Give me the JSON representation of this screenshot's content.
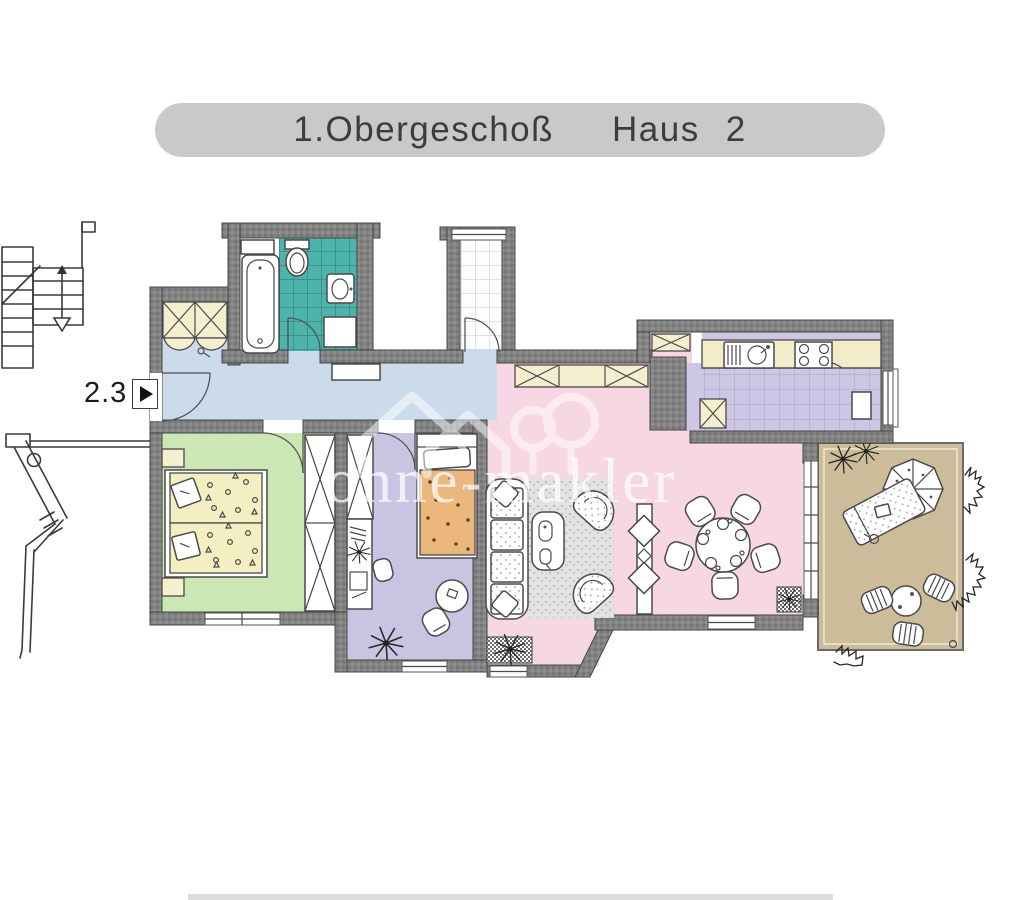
{
  "header": {
    "floor_label": "1.Obergeschoß",
    "building_word": "Haus",
    "building_number": "2"
  },
  "entrance": {
    "unit_number": "2.3"
  },
  "watermark": {
    "text": "ohne-makler"
  },
  "rooms": [
    {
      "id": "hallway",
      "color": "#ccdbeb"
    },
    {
      "id": "bathroom",
      "color": "#4eb4ab"
    },
    {
      "id": "storage-wc",
      "color": "#ffffff"
    },
    {
      "id": "bedroom",
      "color": "#cbe7b3"
    },
    {
      "id": "kids-room",
      "color": "#cac4e2"
    },
    {
      "id": "living-dining-room",
      "color": "#f7d7e3"
    },
    {
      "id": "kitchen",
      "color": "#cdc7e5"
    },
    {
      "id": "balcony",
      "color": "#cdbc9a"
    }
  ],
  "colors": {
    "wall": "#828282",
    "hall": "#ccdbeb",
    "bathtile": "#4eb4ab",
    "bathgrout": "#2d837b",
    "bedroom": "#cbe7b3",
    "linen": "#f4eec3",
    "kids": "#cac4e2",
    "kidcover": "#ecb77c",
    "living": "#f7d7e3",
    "kitchen": "#cdc7e5",
    "counter": "#f2ecca",
    "cabinet": "#f5efd0",
    "balcony": "#cdbc9a",
    "titlebg": "#c9c9c9",
    "titletext": "#3d3d3d"
  }
}
